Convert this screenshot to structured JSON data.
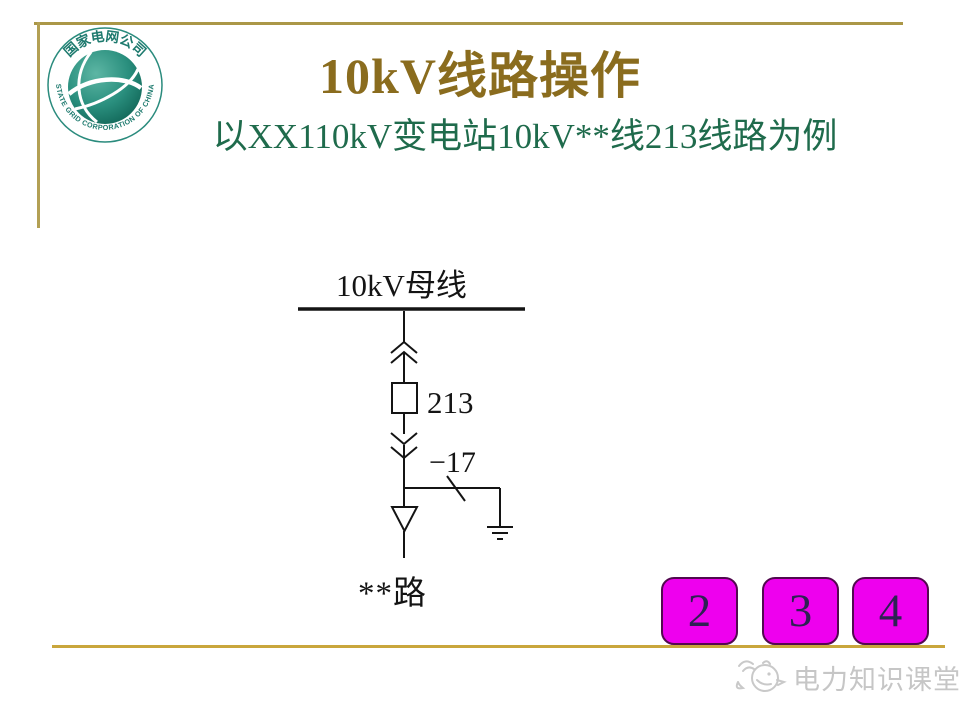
{
  "slide": {
    "title": "10kV线路操作",
    "subtitle": "以XX110kV变电站10kV**线213线路为例"
  },
  "logo": {
    "cn_arc_text": "国家电网公司",
    "en_arc_text": "STATE GRID CORPORATION OF CHINA"
  },
  "diagram": {
    "bus_label": "10kV母线",
    "breaker_label": "213",
    "disconnector_label": "−17",
    "feeder_label": "**路"
  },
  "nav": {
    "buttons": [
      "2",
      "3",
      "4"
    ]
  },
  "watermark": {
    "text": "电力知识课堂"
  },
  "colors": {
    "title_gold": "#8a6c1e",
    "subtitle_green": "#1f6b4c",
    "frame_gold": "#b3a054",
    "bottom_line_gold": "#c9a63c",
    "button_magenta": "#ee00ee",
    "button_border": "#52094f",
    "button_digit": "#2d2153",
    "diagram_ink": "#141414",
    "logo_teal": "#1d7a6e",
    "watermark_gray": "#c6c6c6"
  }
}
